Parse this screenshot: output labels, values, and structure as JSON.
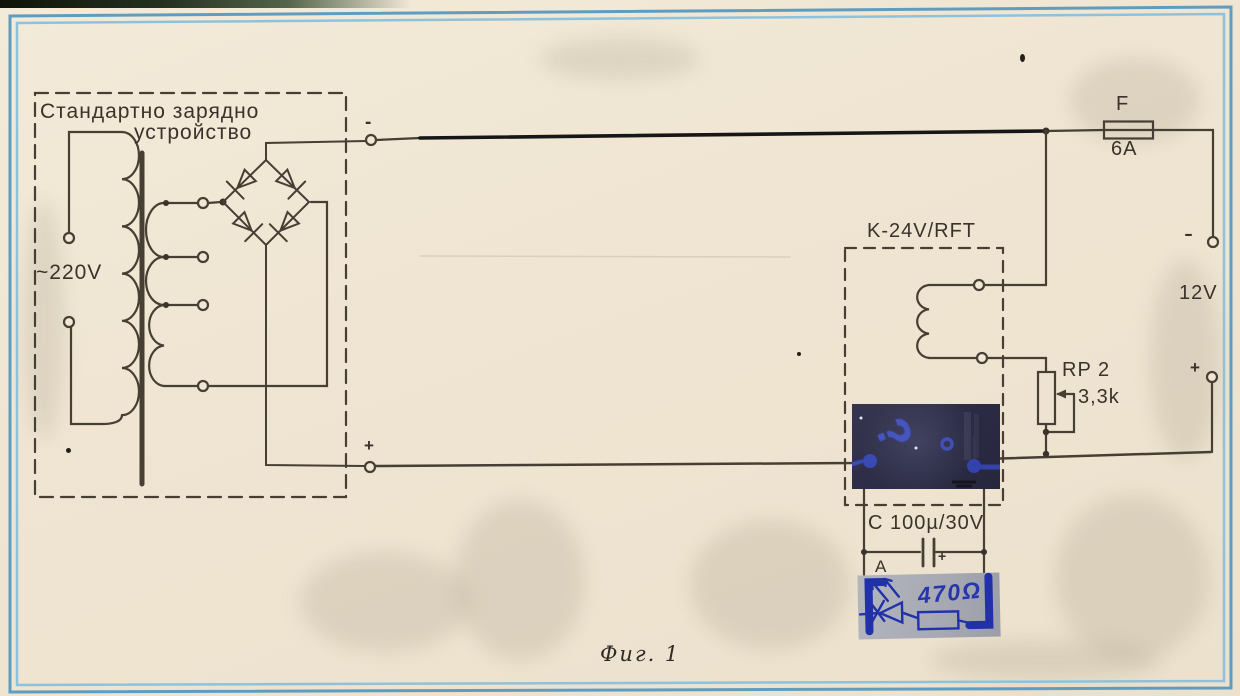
{
  "page": {
    "caption": "Фиг. 1"
  },
  "charger": {
    "label_line1": "Стандартно зарядно",
    "label_line2": "устройство",
    "mains": "~220V",
    "out_minus": "-",
    "out_plus": "+"
  },
  "relay": {
    "label": "K-24V/RFT"
  },
  "fuse": {
    "name": "F",
    "rating": "6A"
  },
  "battery": {
    "voltage": "12V",
    "minus": "-",
    "plus": "+"
  },
  "pot": {
    "name": "RP 2",
    "value": "3,3k"
  },
  "capacitor": {
    "label": "C 100µ/30V",
    "plus": "+"
  },
  "led_branch": {
    "marker": "A",
    "resistor": "470Ω"
  },
  "annotation": {
    "question": "?"
  },
  "colors": {
    "paper": "#efe5d2",
    "ink": "#473e34",
    "traced_line": "#161616",
    "frame_blue": "#5f9dc0",
    "patch_navy": "#2b2b45",
    "handwriting_blue": "#2637ad"
  }
}
